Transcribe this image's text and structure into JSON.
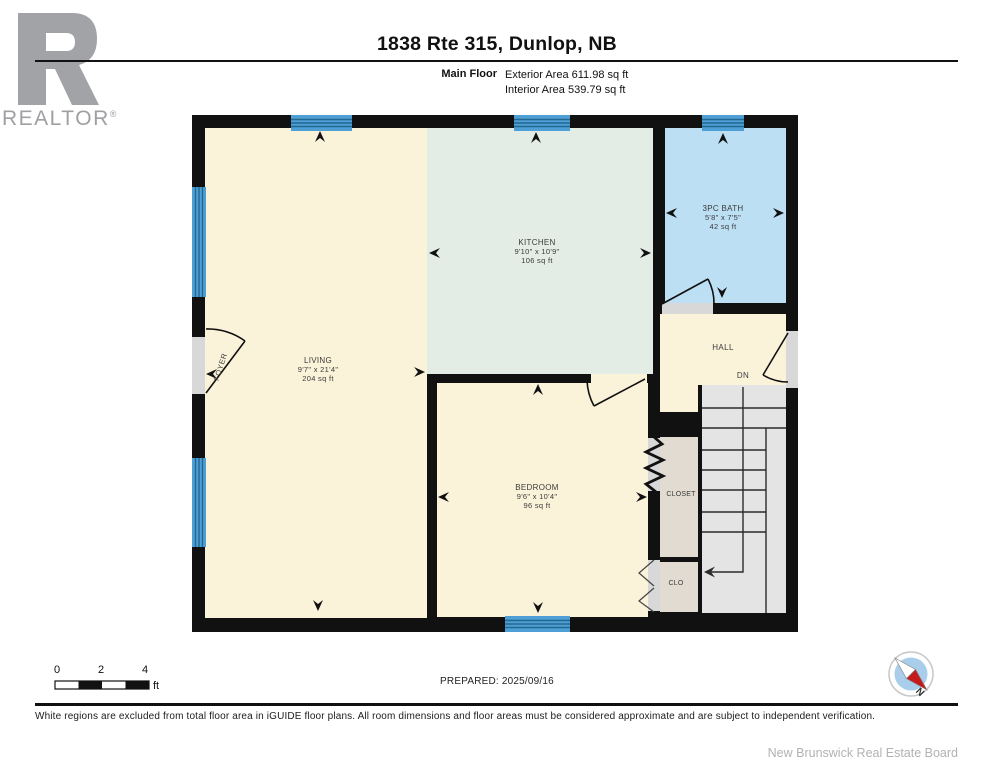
{
  "header": {
    "title": "1838 Rte 315, Dunlop, NB",
    "floor_label": "Main Floor",
    "exterior_area": "Exterior Area 611.98 sq ft",
    "interior_area": "Interior Area 539.79 sq ft"
  },
  "logo": {
    "brand": "REALTOR",
    "registered": "®"
  },
  "rooms": {
    "living": {
      "name": "LIVING",
      "dims": "9'7\" x 21'4\"",
      "area": "204 sq ft"
    },
    "kitchen": {
      "name": "KITCHEN",
      "dims": "9'10\" x 10'9\"",
      "area": "106 sq ft"
    },
    "bath": {
      "name": "3PC BATH",
      "dims": "5'8\" x 7'5\"",
      "area": "42 sq ft"
    },
    "bedroom": {
      "name": "BEDROOM",
      "dims": "9'6\" x 10'4\"",
      "area": "96 sq ft"
    },
    "hall": {
      "name": "HALL"
    },
    "closet": {
      "name": "CLOSET"
    },
    "clo": {
      "name": "CLO"
    },
    "foyer": {
      "name": "FOYER"
    },
    "stairs": {
      "direction_label": "DN"
    }
  },
  "scale_bar": {
    "tick0": "0",
    "tick2": "2",
    "tick4": "4",
    "unit": "ft"
  },
  "compass": {
    "north_label": "N"
  },
  "footer": {
    "prepared": "PREPARED: 2025/09/16",
    "disclaimer": "White regions are excluded from total floor area in iGUIDE floor plans. All room dimensions and floor areas must be considered approximate and are subject to independent verification.",
    "board": "New Brunswick Real Estate Board"
  },
  "colors": {
    "wall_black": "#111111",
    "room_cream": "#FBF2DA",
    "kitchen_mint": "#E3EDE5",
    "bath_blue": "#BDDFF4",
    "closet_beige": "#E2DBD1",
    "stairs_gray": "#E4E4E4",
    "window_blue": "#4D9FD6",
    "threshold_gray": "#D8D8D8",
    "logo_gray": "#A1A3A6",
    "compass_red": "#C51A1B",
    "compass_blue": "#A9CEEC"
  }
}
